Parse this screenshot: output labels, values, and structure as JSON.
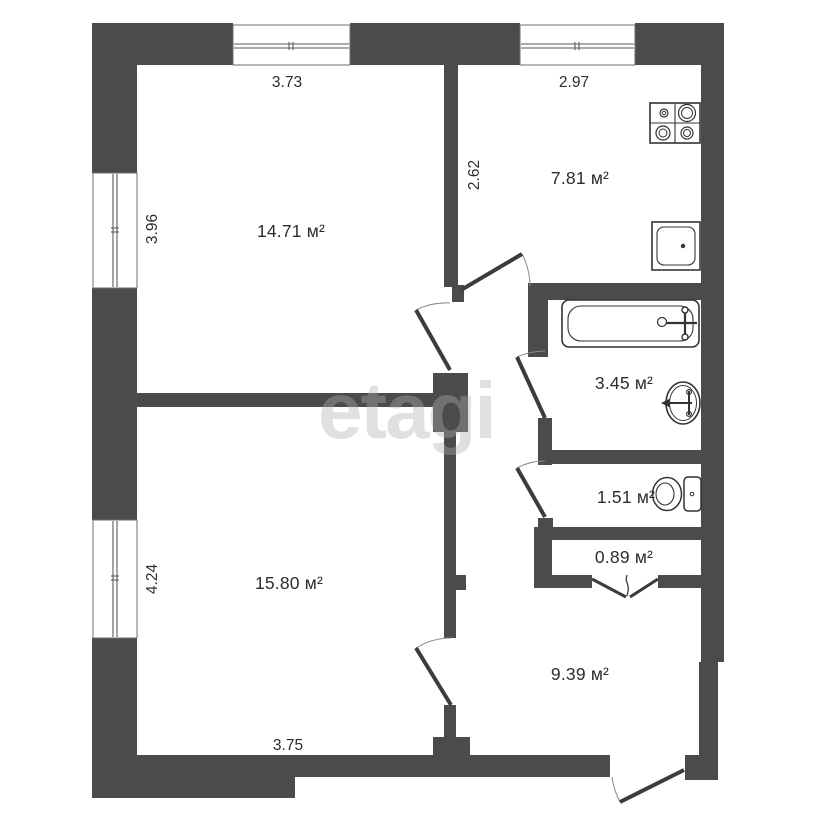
{
  "document_type": "apartment-floor-plan",
  "watermark": "etagi",
  "area_unit": "м²",
  "rooms": [
    {
      "name": "living-room-1",
      "area": "14.71 м²"
    },
    {
      "name": "kitchen",
      "area": "7.81 м²"
    },
    {
      "name": "bathroom",
      "area": "3.45 м²"
    },
    {
      "name": "wc",
      "area": "1.51 м²"
    },
    {
      "name": "storage",
      "area": "0.89 м²"
    },
    {
      "name": "hallway",
      "area": "9.39 м²"
    },
    {
      "name": "living-room-2",
      "area": "15.80 м²"
    }
  ],
  "dimensions": [
    {
      "value": "3.73",
      "edge": "top",
      "along": "living-room-1 width"
    },
    {
      "value": "2.97",
      "edge": "top",
      "along": "kitchen width"
    },
    {
      "value": "3.96",
      "edge": "left",
      "along": "living-room-1 height"
    },
    {
      "value": "2.62",
      "edge": "interior",
      "along": "kitchen height"
    },
    {
      "value": "4.24",
      "edge": "left",
      "along": "living-room-2 height"
    },
    {
      "value": "3.75",
      "edge": "bottom",
      "along": "living-room-2 width"
    }
  ],
  "fixtures": [
    "stove",
    "kitchen-sink",
    "bathtub",
    "washbasin",
    "toilet"
  ],
  "openings": [
    "kitchen-door",
    "living-room-1-door",
    "bathroom-door",
    "wc-door",
    "storage-folding-door",
    "living-room-2-door",
    "entrance-door",
    "4 windows"
  ],
  "colors": {
    "wall": "#4b4b4b",
    "line": "#3c3c3c",
    "text": "#2d2d2d",
    "background": "#ffffff",
    "watermark": "#b0b0b0"
  }
}
